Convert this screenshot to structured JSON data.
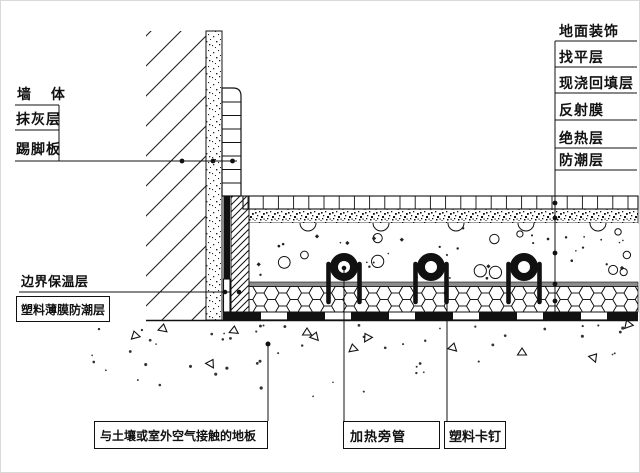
{
  "colors": {
    "line": "#1a1a1a",
    "reflective_film_gray": "#8c8c8c",
    "background": "#ffffff"
  },
  "labels": {
    "wall": "墙 体",
    "plaster_layer": "抹灰层",
    "skirting_board": "踢脚板",
    "edge_insulation": "边界保温层",
    "plastic_film_moisture_barrier": "塑料薄膜防潮层",
    "floor_finish": "地面装饰",
    "leveling_layer": "找平层",
    "cast_in_place_backfill": "现浇回填层",
    "reflective_film": "反射膜",
    "thermal_insulation": "绝热层",
    "moisture_barrier": "防潮层",
    "floor_contact_soil": "与土壤或室外空气接触的地板",
    "heating_pipe": "加热旁管",
    "plastic_clip": "塑料卡钉"
  }
}
